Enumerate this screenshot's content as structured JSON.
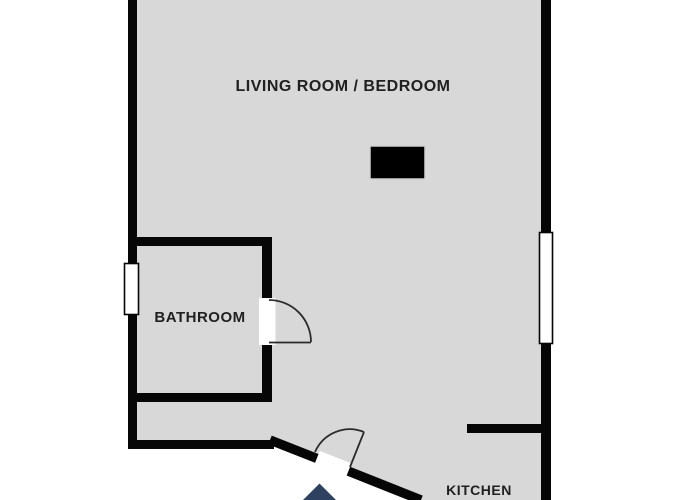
{
  "plan": {
    "type": "apartment-floor-plan",
    "rooms": [
      {
        "id": "living-room-bedroom",
        "label": "LIVING ROOM / BEDROOM"
      },
      {
        "id": "bathroom",
        "label": "BATHROOM"
      },
      {
        "id": "kitchen",
        "label": "KITCHEN"
      }
    ],
    "elements": {
      "windows": [
        "bathroom-window",
        "living-room-window"
      ],
      "doors": [
        "bathroom-door",
        "entrance-door"
      ],
      "furniture": [
        "furniture-block"
      ],
      "compass": "north-arrow"
    }
  },
  "colors": {
    "floor": "#d8d8d8",
    "wall": "#060606",
    "outside": "#ffffff",
    "door_line": "#2b2b2b",
    "furniture": "#000000",
    "compass": "#2f4160",
    "text": "#202020"
  }
}
